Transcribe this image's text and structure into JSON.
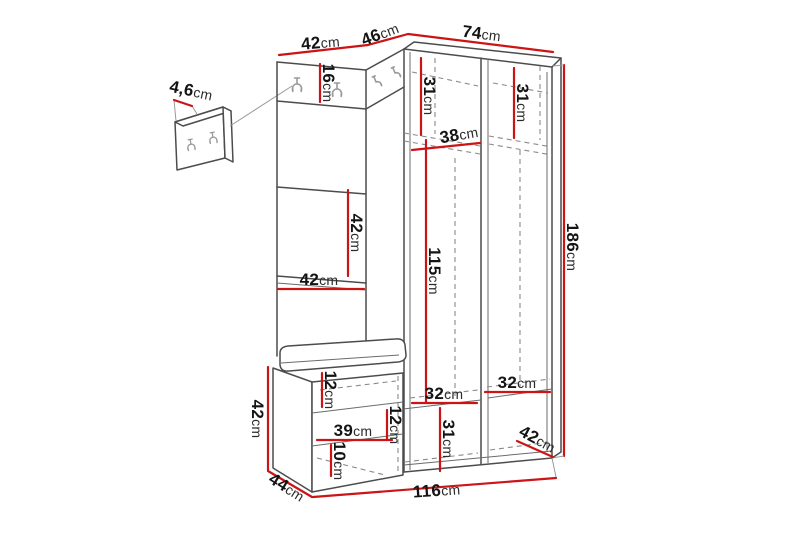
{
  "diagram": {
    "unit": "cm",
    "colors": {
      "dimension_line": "#cc1417",
      "outline": "#4c4c4c",
      "hidden_line": "#8a8a8a",
      "label": "#141414",
      "hook": "#9a9a9a",
      "background": "#ffffff"
    },
    "dimensions": {
      "wall_panel_depth": "4,6",
      "top_left_width": "42",
      "top_corner_width": "46",
      "top_right_width": "74",
      "hook_panel_height": "16",
      "left_top_compartment_height": "31",
      "right_top_compartment_height": "31",
      "top_shelf_depth": "38",
      "middle_panel_height": "42",
      "middle_panel_width": "42",
      "hanging_space_height": "115",
      "total_height": "186",
      "seat_thickness": "12",
      "bench_inner_width": "39",
      "bench_middle_height": "12",
      "bench_base_height": "10",
      "bench_height": "42",
      "bottom_left_inner_width": "32",
      "bottom_right_inner_width": "32",
      "bottom_compartment_height": "31",
      "wardrobe_depth": "42",
      "bench_depth": "44",
      "total_width": "116"
    }
  }
}
